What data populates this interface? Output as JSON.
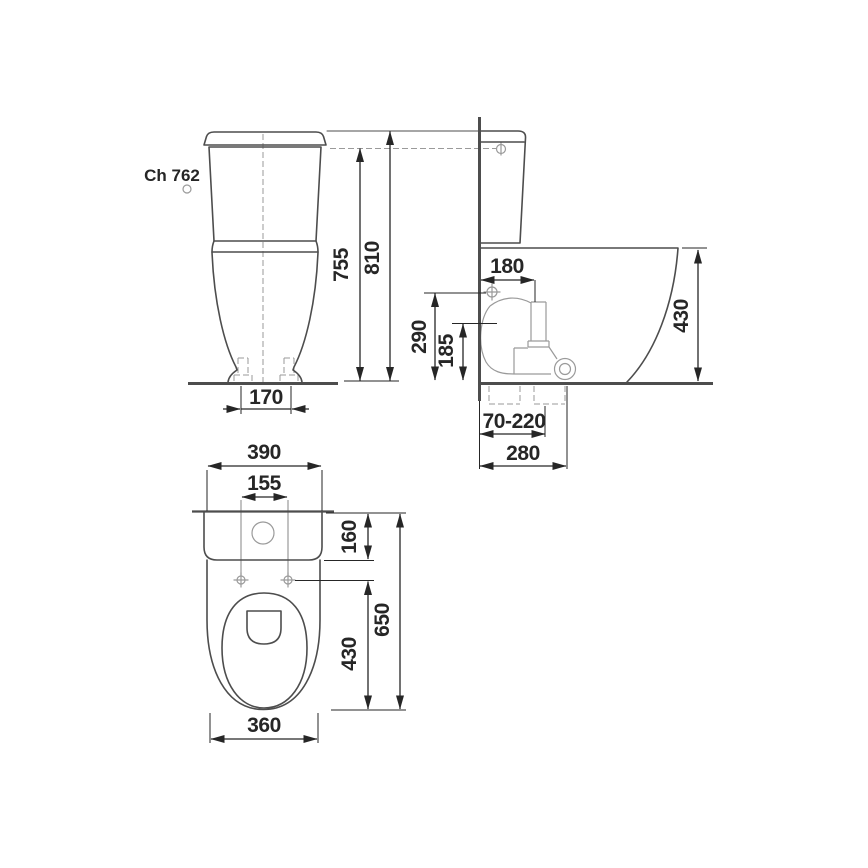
{
  "page": {
    "background": "#ffffff"
  },
  "colors": {
    "ink": "#262626",
    "outline": "#4d4d4d",
    "detail": "#9a9a9a",
    "dashes": "#9a9a9a"
  },
  "drawing": {
    "model_label": "Ch 762",
    "views": {
      "front_view": {
        "name": "front view",
        "dims": {
          "height_body": "755",
          "height_total": "810",
          "foot_width": "170"
        }
      },
      "side_view": {
        "name": "side view",
        "dims": {
          "flush_pipe_offset": "180",
          "water_inlet_height": "290",
          "outlet_height": "185",
          "rim_height": "430",
          "outlet_adjust_range": "70-220",
          "base_depth": "280"
        }
      },
      "top_view": {
        "name": "top view",
        "dims": {
          "total_width": "390",
          "seat_holes_spacing": "155",
          "tank_depth": "160",
          "total_depth": "650",
          "seat_length": "430",
          "bowl_width": "360"
        }
      }
    }
  }
}
